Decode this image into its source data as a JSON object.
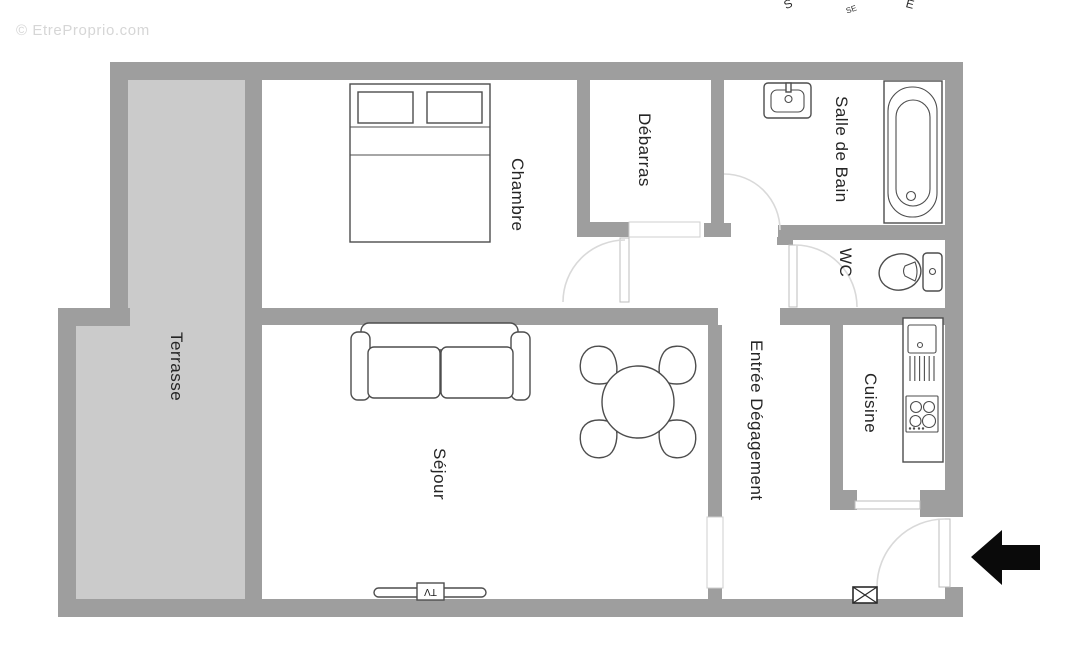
{
  "watermark": {
    "text": "© EtreProprio.com"
  },
  "compass": {
    "s": "S",
    "se": "SE",
    "e": "E"
  },
  "rooms": {
    "terrasse": {
      "label": "Terrasse"
    },
    "chambre": {
      "label": "Chambre"
    },
    "debarras": {
      "label": "Débarras"
    },
    "salle_de_bain": {
      "label": "Salle de Bain"
    },
    "wc": {
      "label": "WC"
    },
    "cuisine": {
      "label": "Cuisine"
    },
    "entree_degagement": {
      "label": "Entrée Dégagement"
    },
    "sejour": {
      "label": "Séjour"
    }
  },
  "furniture": {
    "tv_label": "TV"
  },
  "colors": {
    "wall": "#9e9e9e",
    "terrace_fill": "#cbcbcb",
    "outline": "#4d4d4d",
    "door_arc": "#d9d9d9",
    "opening": "#cfcfcf",
    "watermark": "#d6d6d6",
    "arrow": "#0a0a0a",
    "label_text": "#252525",
    "background": "#ffffff"
  }
}
